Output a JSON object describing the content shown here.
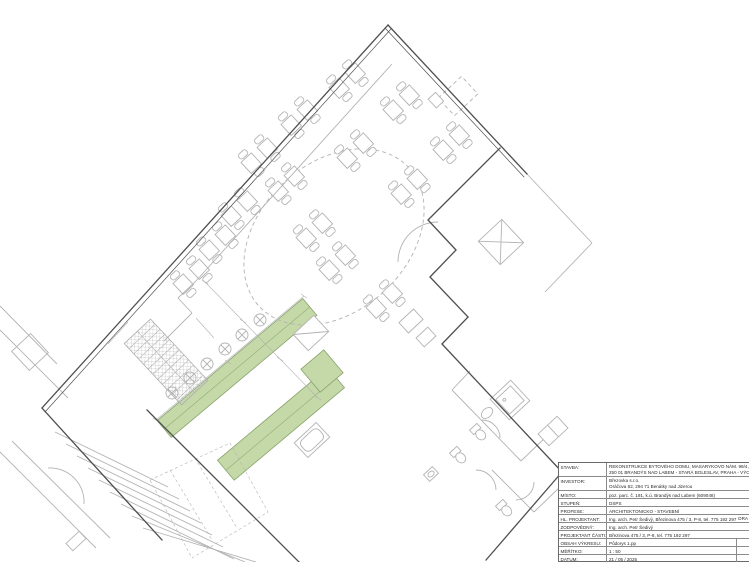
{
  "colors": {
    "wall": "#4f4f4f",
    "light": "#b3b3b3",
    "highlight": "#c4d8a8",
    "highlight-stroke": "#87a26b"
  },
  "plan": {
    "type": "architectural floor plan, rotated restaurant/apartment building level with table seating, ramps highlighted green, staircases and sanitary rooms"
  },
  "title_block": {
    "rows": [
      {
        "label": "STAVBA:",
        "value": "REKONSTRUKCE BYTOVÉHO DOMU, MASARYKOVO NÁM. 99/4,",
        "value2": "250 01 BRANDÝS NAD LABEM - STARÁ BOLESLAV, PRAHA - VÝCHOD"
      },
      {
        "label": "INVESTOR:",
        "value": "Březovka s.r.o.",
        "value2": "Oráčova 62, 294 71 Benátky nad Jizerou"
      },
      {
        "label": "MÍSTO:",
        "value": "poz. parc. č. 191, k.ú. Brandýs nad Labem (609048)"
      },
      {
        "label": "STUPEŇ:",
        "value": "DSPS"
      },
      {
        "label": "PROFESE:",
        "value": "ARCHITEKTONICKO - STAVEBNÍ"
      },
      {
        "label": "HL. PROJEKTANT:",
        "value": "Ing. arch. Petr Šedivý, Březinova 475 / 3, P-8, tel. 775 192 297",
        "side": "DRA"
      },
      {
        "label": "ZODPOVĚDNÝ:",
        "value": "Ing. arch. Petr Šedivý"
      },
      {
        "label": "PROJEKTANT ČÁSTI:",
        "value": "Březinova 475 / 3, P-8, tel. 775 192 297"
      },
      {
        "label": "OBSAH VÝKRESU:",
        "value": "Půdorys 1.pp"
      },
      {
        "label": "MĚŘÍTKO:",
        "value": "1 : 50"
      },
      {
        "label": "DATUM:",
        "value": "21 / 05 / 2025"
      }
    ]
  }
}
